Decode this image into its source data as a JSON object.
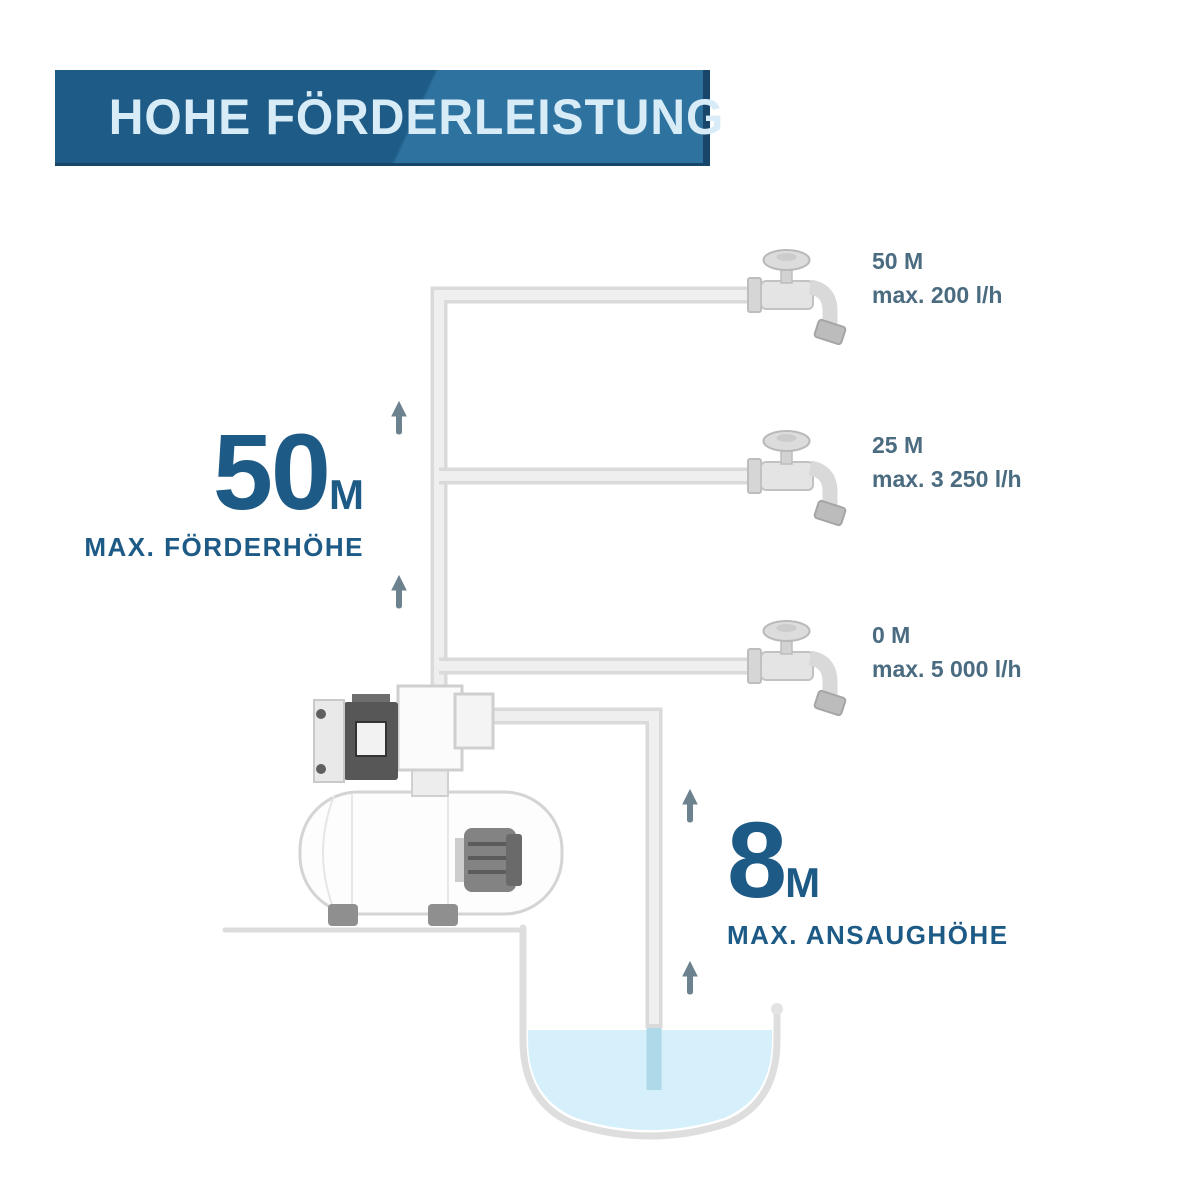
{
  "banner": {
    "title": "HOHE FÖRDERLEISTUNG"
  },
  "colors": {
    "accent": "#1d5a86",
    "labelSlate": "#4a6b80",
    "bannerBg": "#1e5c87",
    "bannerBgLight": "#2e73a0",
    "bannerEdge": "#17466a",
    "bannerText": "#d8ecf8",
    "pipeEdge": "#dadada",
    "pipeFill": "#efefef",
    "water": "#d6f0fb",
    "pipeUnderwater": "#aed9e8",
    "arrow": "#6d828f",
    "lineGray": "#dcdcdc"
  },
  "outlets": [
    {
      "height": "50 M",
      "flow": "max. 200 l/h"
    },
    {
      "height": "25 M",
      "flow": "max. 3 250 l/h"
    },
    {
      "height": "0 M",
      "flow": "max. 5 000 l/h"
    }
  ],
  "delivery_head": {
    "value": "50",
    "unit": "M",
    "label": "MAX. FÖRDERHÖHE"
  },
  "suction_height": {
    "value": "8",
    "unit": "M",
    "label": "MAX. ANSAUGHÖHE"
  }
}
